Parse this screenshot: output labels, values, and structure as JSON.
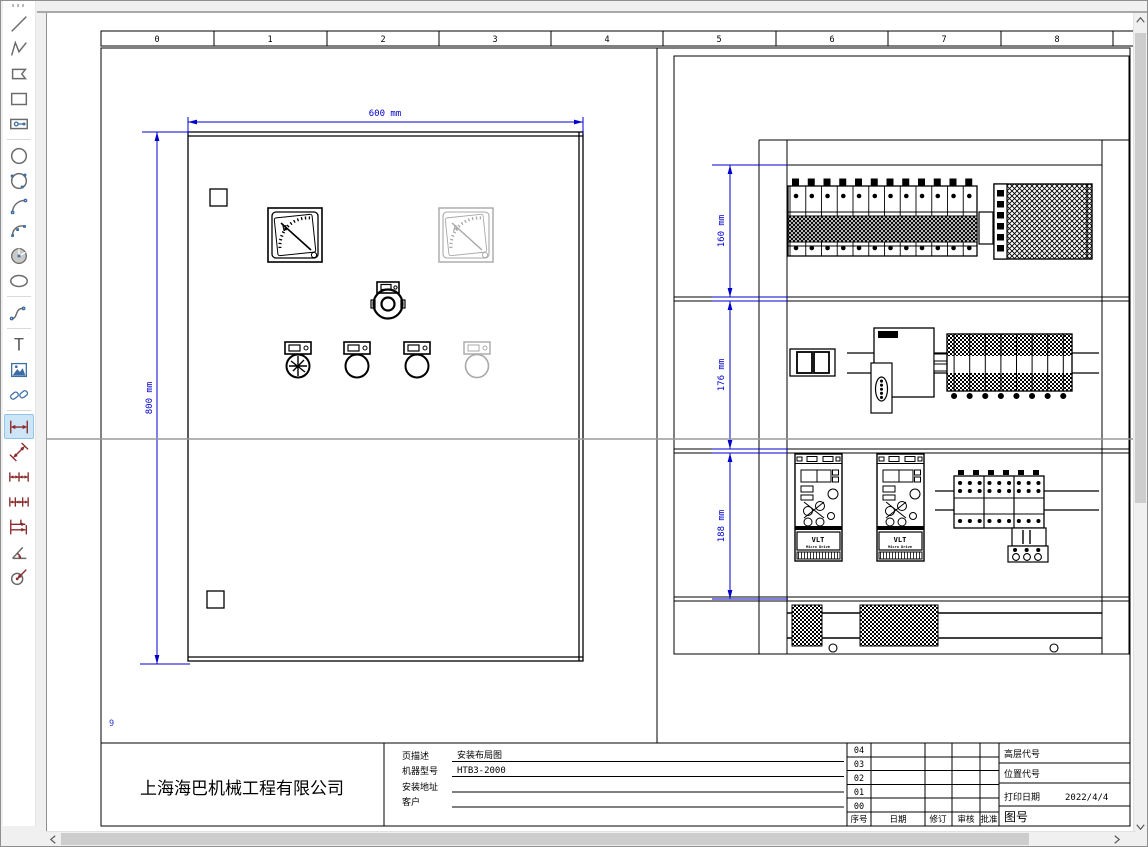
{
  "toolbar": {
    "tools": [
      {
        "name": "line",
        "selected": false
      },
      {
        "name": "polyline",
        "selected": false
      },
      {
        "name": "polygon",
        "selected": false
      },
      {
        "name": "rectangle",
        "selected": false
      },
      {
        "name": "slot",
        "selected": false
      },
      {
        "name": "circle",
        "selected": false
      },
      {
        "name": "circle-3point",
        "selected": false
      },
      {
        "name": "arc",
        "selected": false
      },
      {
        "name": "arc-3point",
        "selected": false
      },
      {
        "name": "pie",
        "selected": false
      },
      {
        "name": "ellipse",
        "selected": false
      },
      {
        "name": "spline",
        "selected": false
      },
      {
        "name": "text",
        "selected": false,
        "glyph": "T"
      },
      {
        "name": "image",
        "selected": false
      },
      {
        "name": "hyperlink",
        "selected": false
      },
      {
        "name": "dim-horizontal",
        "selected": true
      },
      {
        "name": "dim-aligned",
        "selected": false
      },
      {
        "name": "dim-chain",
        "selected": false
      },
      {
        "name": "dim-chain-2",
        "selected": false
      },
      {
        "name": "dim-baseline",
        "selected": false
      },
      {
        "name": "dim-angle",
        "selected": false
      },
      {
        "name": "dim-radius",
        "selected": false
      }
    ]
  },
  "ruler": {
    "cells": [
      "0",
      "1",
      "2",
      "3",
      "4",
      "5",
      "6",
      "7",
      "8"
    ]
  },
  "drawing": {
    "page_number": "9",
    "dim_width": "600 mm",
    "dim_height": "800 mm",
    "dim_section1": "160 mm",
    "dim_section2": "176 mm",
    "dim_section3": "188 mm",
    "voltmeter_label": "V",
    "ammeter_label": "A",
    "vfd_brand": "VLT",
    "vfd_model": "Micro Drive"
  },
  "title_block": {
    "company": "上海海巴机械工程有限公司",
    "fields": [
      {
        "label": "页描述",
        "value": "安装布局图"
      },
      {
        "label": "机器型号",
        "value": "HTB3-2000"
      },
      {
        "label": "安装地址",
        "value": ""
      },
      {
        "label": "客户",
        "value": ""
      }
    ],
    "revision": {
      "rows": [
        "04",
        "03",
        "02",
        "01",
        "00"
      ],
      "headers": [
        "序号",
        "日期",
        "修订",
        "审核",
        "批准"
      ]
    },
    "info": {
      "high_level_label": "高层代号",
      "location_label": "位置代号",
      "print_date_label": "打印日期",
      "print_date": "2022/4/4",
      "drawing_no_label": "图号"
    }
  },
  "colors": {
    "dimension": "#0000cd",
    "guide": "#9a9a9a",
    "ghost": "#a8a8a8",
    "selected_tool_bg": "#cde6f7"
  }
}
